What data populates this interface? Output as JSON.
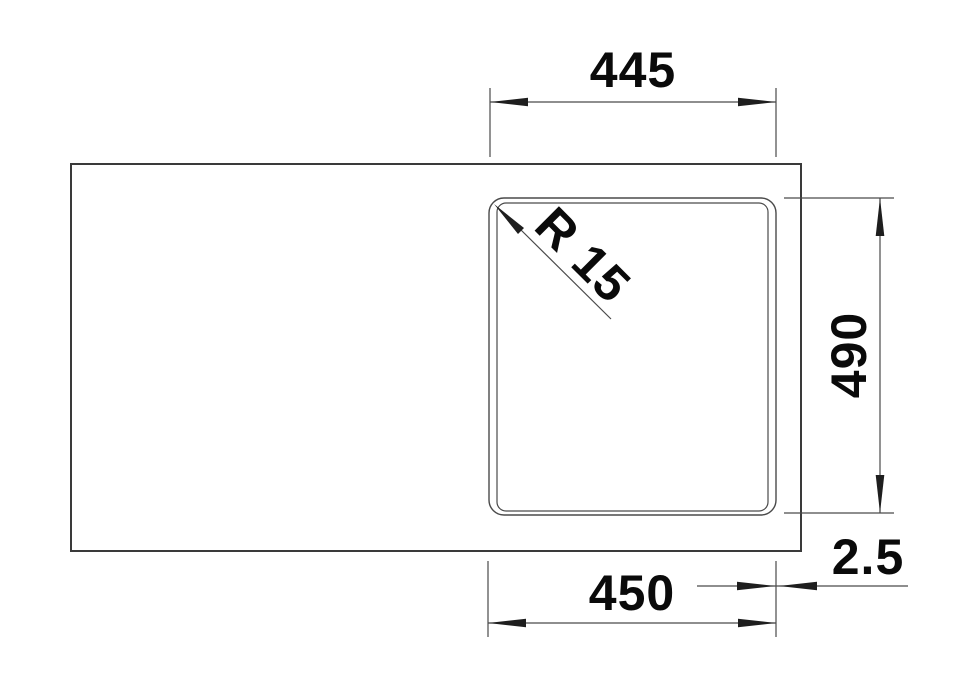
{
  "drawing": {
    "title": "sink-dimension-drawing",
    "labels": {
      "top_width": "445",
      "side_height": "490",
      "bottom_width": "450",
      "edge_offset": "2.5",
      "corner_radius": "R 15"
    },
    "colors": {
      "line": "#4a4a4a",
      "heavy_line": "#3a3a3a",
      "text": "#0a0a0a",
      "background": "#ffffff"
    }
  }
}
